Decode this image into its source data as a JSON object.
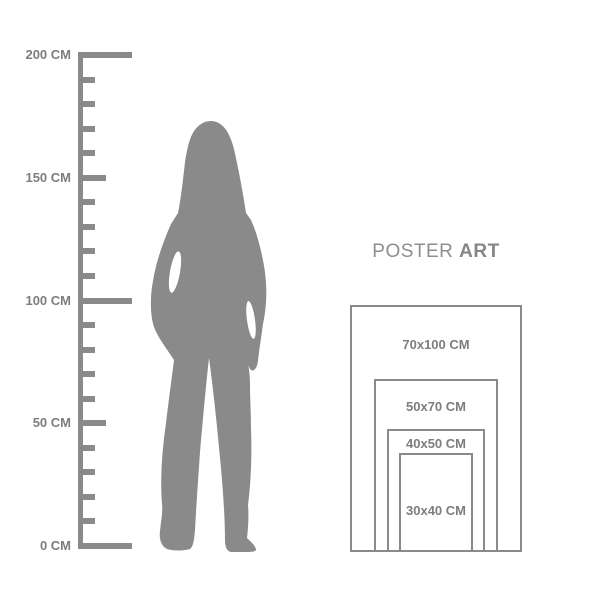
{
  "colors": {
    "silhouette": "#8a8a8a",
    "ruler": "#8a8a8a",
    "border": "#8a8a8a",
    "text": "#7d7d7d",
    "title": "#8e8e8e"
  },
  "ruler": {
    "unit": "CM",
    "max": 200,
    "min": 0,
    "step": 10,
    "labels": [
      {
        "value": 200,
        "text": "200 CM"
      },
      {
        "value": 150,
        "text": "150 CM"
      },
      {
        "value": 100,
        "text": "100 CM"
      },
      {
        "value": 50,
        "text": "50 CM"
      },
      {
        "value": 0,
        "text": "0 CM"
      }
    ]
  },
  "figure": {
    "icon": "woman-silhouette"
  },
  "panel": {
    "title_regular": "POSTER",
    "title_bold": "ART",
    "sizes": [
      {
        "label": "70x100 CM",
        "width_cm": 70,
        "height_cm": 100
      },
      {
        "label": "50x70 CM",
        "width_cm": 50,
        "height_cm": 70
      },
      {
        "label": "40x50 CM",
        "width_cm": 40,
        "height_cm": 50
      },
      {
        "label": "30x40 CM",
        "width_cm": 30,
        "height_cm": 40
      }
    ]
  }
}
